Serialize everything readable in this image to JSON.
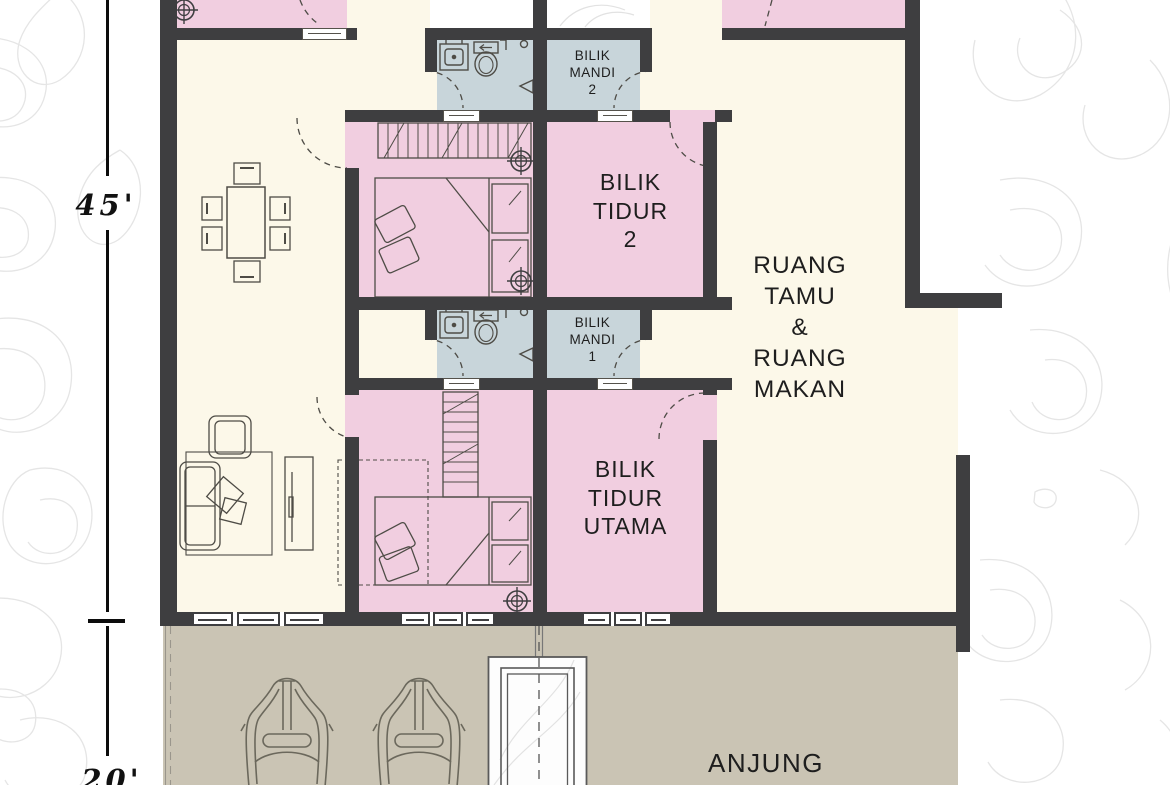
{
  "document": {
    "type": "residential floor plan",
    "language": "Malay"
  },
  "rooms": {
    "bathroom_2": {
      "name_lines": [
        "BILIK",
        "MANDI",
        "2"
      ]
    },
    "bedroom_2": {
      "name_lines": [
        "BILIK",
        "TIDUR",
        "2"
      ]
    },
    "bathroom_1": {
      "name_lines": [
        "BILIK",
        "MANDI",
        "1"
      ]
    },
    "master_bedroom": {
      "name_lines": [
        "BILIK",
        "TIDUR",
        "UTAMA"
      ]
    },
    "living_dining": {
      "name_lines": [
        "RUANG",
        "TAMU",
        "&",
        "RUANG",
        "MAKAN"
      ]
    },
    "porch": {
      "label": "ANJUNG"
    }
  },
  "dimensions": {
    "house_depth": "45'",
    "porch_depth": "20'"
  },
  "colors": {
    "bedroom_pink": "#f1cee0",
    "bathroom_blue": "#c8d5da",
    "interior_cream": "#fcf8e9",
    "porch_tan": "#cac4b4",
    "wall_dark": "#3e3e40",
    "contour_gray": "#e5e5e5"
  },
  "icons": [
    "ceiling-fan-icon",
    "toilet-icon",
    "sink-icon",
    "tap-icon",
    "shower-icon",
    "double-bed-icon",
    "wardrobe-icon",
    "dining-table-icon",
    "chair-icon",
    "sofa-icon",
    "armchair-icon",
    "cushion-icon",
    "rug-icon",
    "tv-console-icon",
    "car-icon",
    "door-swing-arc",
    "window",
    "entrance-steps",
    "walkway-line",
    "dimension-line",
    "contour-lines"
  ]
}
